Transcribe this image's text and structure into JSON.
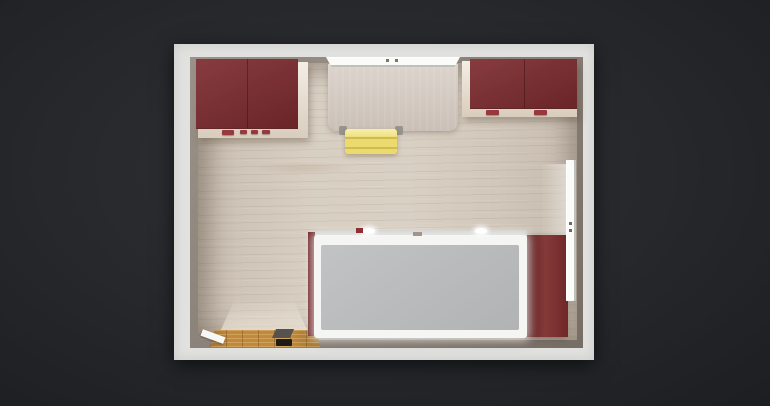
{
  "scene": {
    "view": "top-down room plan render",
    "background_color": "#26282c",
    "room": {
      "wall_outer_color": "#e1e1df",
      "wall_inner_color": "#8d8378",
      "floor_color": "#d6ccbf"
    },
    "objects": {
      "cabinet_top_left": {
        "color": "#7c2b2f",
        "trim_color": "#eee4d6",
        "handle_color": "#96383c"
      },
      "cabinet_top_right": {
        "color": "#7c2b2f",
        "trim_color": "#eee4d6",
        "handle_color": "#96383c"
      },
      "desk": {
        "color": "#d7cdc5",
        "foot_color": "#97938d"
      },
      "chair": {
        "color": "#ebda6d"
      },
      "window_top": {
        "color": "#fbfbfa"
      },
      "window_right": {
        "color": "#fbfbfa"
      },
      "wardrobe": {
        "color": "#7c2b2b"
      },
      "bed": {
        "frame_color": "#f5f5f3",
        "mattress_color": "#babcbe",
        "headboard_color": "#6e2426",
        "shelf_color": "#dededc",
        "accessory_red_color": "#8d2f33",
        "accessory_small_color": "#a5928a"
      },
      "door": {
        "threshold_color": "#c08a3e",
        "leaf_color": "#f7f7f5",
        "panel_color": "#56534e",
        "mat_color": "#1d1b18"
      }
    }
  }
}
